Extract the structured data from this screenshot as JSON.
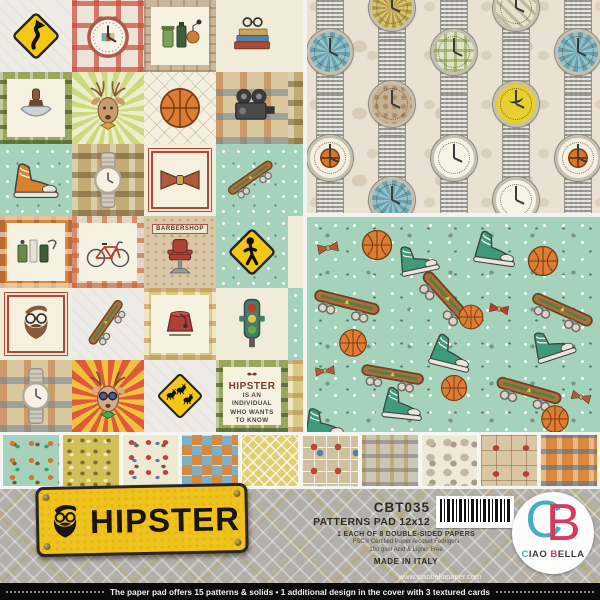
{
  "product": {
    "sku": "CBT035",
    "pad_line": "PATTERNS PAD 12x12",
    "papers_line": "1 EACH OF 8 DOUBLE-SIDED PAPERS",
    "fsc_line": "FSC® Certified Paper Arcoset Fedrigoni",
    "gsm_line": "190 gsm Acid & Lignin Free",
    "made_in": "MADE IN ITALY",
    "website": "www.ciaobellapaper.com"
  },
  "sign": {
    "title": "HIPSTER"
  },
  "brand": {
    "mono_c": "C",
    "mono_b": "B",
    "w1": "C",
    "w2": "IAO",
    "w3": "B",
    "w4": "ELLA"
  },
  "footer": {
    "text": "The paper pad offers 15 patterns & solids • 1 additional design in the cover with 3 textured cards"
  },
  "collage": {
    "barbershop_label": "BARBERSHOP",
    "quote_title": "HIPSTER",
    "quote_lines": [
      "IS AN",
      "INDIVIDUAL",
      "WHO WANTS",
      "TO KNOW"
    ],
    "tiles": [
      {
        "name": "curve-road-sign",
        "icon": "sign-curve",
        "bg": "paper"
      },
      {
        "name": "vintage-clock",
        "icon": "clock",
        "bg": "plaid-red"
      },
      {
        "name": "cologne-bottles",
        "icon": "bottles",
        "bg": "frame-stone",
        "panel": true
      },
      {
        "name": "books-and-glasses",
        "icon": "books",
        "bg": "cream"
      },
      {
        "name": "watch-edge",
        "icon": "wristwatch",
        "bg": "cream"
      },
      {
        "name": "shaving-kit",
        "icon": "shave",
        "bg": "plaid-green",
        "panel": true
      },
      {
        "name": "deer-portrait",
        "icon": "deer",
        "bg": "sunburst-green"
      },
      {
        "name": "basketball",
        "icon": "basketball",
        "bg": "diamond-cream"
      },
      {
        "name": "movie-camera",
        "icon": "camera",
        "bg": "plaid-multi"
      },
      {
        "name": "plaid-edge",
        "bg": "plaid-olive"
      },
      {
        "name": "orange-sneakers",
        "icon": "sneaker",
        "bg": "mint-dots",
        "color": "#d8812f"
      },
      {
        "name": "wristwatch-plaid",
        "icon": "wristwatch",
        "bg": "plaid-olive"
      },
      {
        "name": "bow-tie",
        "icon": "bowtie",
        "bg": "red-frame",
        "panel": true,
        "color": "#b05a3a"
      },
      {
        "name": "skateboard-mint",
        "icon": "skateboard",
        "bg": "mint-dots",
        "rot": -35
      },
      {
        "name": "mint-edge",
        "bg": "mint-dots"
      },
      {
        "name": "grooming-bottles",
        "icon": "groom",
        "bg": "plaid-orange",
        "panel": true
      },
      {
        "name": "bicycle",
        "icon": "bicycle",
        "bg": "plaid-orange2",
        "panel": true
      },
      {
        "name": "barber-chair",
        "type": "barbershop",
        "bg": "sepia"
      },
      {
        "name": "pedestrian-sign",
        "icon": "walk-sign",
        "bg": "mint-dots"
      },
      {
        "name": "cream-edge",
        "bg": "cream"
      },
      {
        "name": "hipster-portrait",
        "icon": "beard-man",
        "bg": "red-frame",
        "panel": true
      },
      {
        "name": "skateboard-gray",
        "icon": "skateboard",
        "bg": "paper",
        "rot": -55
      },
      {
        "name": "fez-hat",
        "icon": "fez",
        "bg": "plaid-tan",
        "panel": true
      },
      {
        "name": "traffic-light",
        "icon": "traffic",
        "bg": "cream"
      },
      {
        "name": "mint-edge-2",
        "bg": "mint-dots"
      },
      {
        "name": "wristwatch-plaid-2",
        "icon": "wristwatch",
        "bg": "plaid-multi"
      },
      {
        "name": "deer-sunglasses",
        "icon": "deer-shades",
        "bg": "sunburst-red"
      },
      {
        "name": "deer-crossing-sign",
        "icon": "deer-sign",
        "bg": "paper"
      },
      {
        "name": "hipster-quote",
        "type": "text",
        "bg": "plaid-green",
        "panel": true
      },
      {
        "name": "plaid-edge-2",
        "bg": "plaid-tan"
      }
    ]
  },
  "watch_pattern": {
    "watches": [
      {
        "x": 0,
        "fy": 52,
        "face": "teal"
      },
      {
        "x": 0,
        "fy": 158,
        "face": "bball"
      },
      {
        "x": 62,
        "fy": 8,
        "face": "gold"
      },
      {
        "x": 62,
        "fy": 104,
        "face": "sepia"
      },
      {
        "x": 62,
        "fy": 200,
        "face": "teal"
      },
      {
        "x": 124,
        "fy": 52,
        "face": "plaid"
      },
      {
        "x": 124,
        "fy": 158,
        "face": "white"
      },
      {
        "x": 186,
        "fy": 8,
        "face": "check"
      },
      {
        "x": 186,
        "fy": 104,
        "face": "yellow"
      },
      {
        "x": 186,
        "fy": 200,
        "face": "white"
      },
      {
        "x": 248,
        "fy": 52,
        "face": "teal"
      },
      {
        "x": 248,
        "fy": 158,
        "face": "bball"
      }
    ]
  },
  "scatter_pattern": {
    "items": [
      {
        "icon": "bowtie",
        "x": 8,
        "y": 18,
        "s": 26,
        "r": -10,
        "c": "#b05a3a"
      },
      {
        "icon": "basketball",
        "x": 48,
        "y": 6,
        "s": 44,
        "r": 0
      },
      {
        "icon": "sneaker",
        "x": 86,
        "y": 16,
        "s": 50,
        "r": -12,
        "c": "#3f9a7a"
      },
      {
        "icon": "sneaker",
        "x": 162,
        "y": 4,
        "s": 54,
        "r": 8,
        "c": "#3f9a7a"
      },
      {
        "icon": "basketball",
        "x": 214,
        "y": 22,
        "s": 44,
        "r": 0
      },
      {
        "icon": "skateboard",
        "x": 2,
        "y": 52,
        "s": 74,
        "r": 14
      },
      {
        "icon": "skateboard",
        "x": 100,
        "y": 46,
        "s": 76,
        "r": 48
      },
      {
        "icon": "basketball",
        "x": 146,
        "y": 82,
        "s": 36,
        "r": 0
      },
      {
        "icon": "bowtie",
        "x": 180,
        "y": 80,
        "s": 24,
        "r": 10,
        "c": "#c0392b"
      },
      {
        "icon": "skateboard",
        "x": 218,
        "y": 60,
        "s": 72,
        "r": 24
      },
      {
        "icon": "sneaker",
        "x": 118,
        "y": 108,
        "s": 54,
        "r": 14,
        "c": "#3f9a7a"
      },
      {
        "icon": "sneaker",
        "x": 220,
        "y": 100,
        "s": 52,
        "r": -18,
        "c": "#3f9a7a"
      },
      {
        "icon": "basketball",
        "x": 26,
        "y": 106,
        "s": 40,
        "r": 0
      },
      {
        "icon": "bowtie",
        "x": 6,
        "y": 142,
        "s": 24,
        "r": -6,
        "c": "#b05a3a"
      },
      {
        "icon": "skateboard",
        "x": 50,
        "y": 126,
        "s": 70,
        "r": 10
      },
      {
        "icon": "basketball",
        "x": 128,
        "y": 152,
        "s": 38,
        "r": 0
      },
      {
        "icon": "skateboard",
        "x": 184,
        "y": 140,
        "s": 74,
        "r": 16
      },
      {
        "icon": "sneaker",
        "x": 70,
        "y": 160,
        "s": 52,
        "r": 6,
        "c": "#3f9a7a"
      },
      {
        "icon": "sneaker",
        "x": -8,
        "y": 180,
        "s": 52,
        "r": 0,
        "c": "#3f9a7a"
      },
      {
        "icon": "skateboard",
        "x": 96,
        "y": 192,
        "s": 72,
        "r": 8
      },
      {
        "icon": "basketball",
        "x": 228,
        "y": 182,
        "s": 40,
        "r": 0
      },
      {
        "icon": "bowtie",
        "x": 262,
        "y": 168,
        "s": 24,
        "r": 16,
        "c": "#b05a3a"
      }
    ]
  },
  "thumbnails": [
    "mint-scatter",
    "yellow-scatter",
    "cream-scatter",
    "deer-check",
    "yellow-diamond",
    "squares-collage",
    "gray-plaid",
    "watch-scatter",
    "barber-collage",
    "orange-plaid"
  ],
  "colors": {
    "mint": "#a5d2ba",
    "beige": "#e9e1d2",
    "sign_yellow": "#efc31c",
    "brand_teal": "#45aec6",
    "brand_red": "#d63a5e",
    "footer_black": "#0b0b0b"
  }
}
